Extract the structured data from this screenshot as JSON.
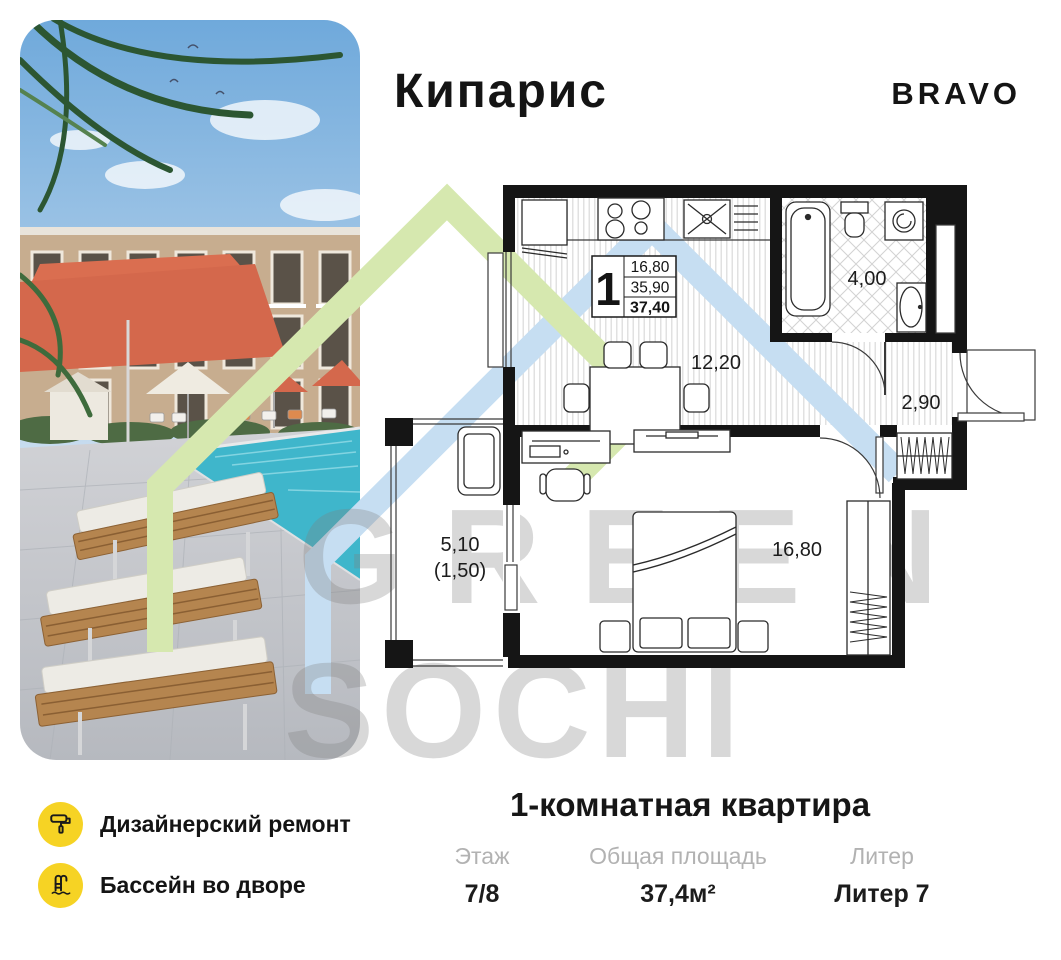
{
  "header": {
    "title": "Кипарис",
    "brand": "BRAVO"
  },
  "floorplan": {
    "stat_box": {
      "rooms": "1",
      "row1": "16,80",
      "row2": "35,90",
      "row3": "37,40"
    },
    "labels": {
      "kitchen": "12,20",
      "bathroom": "4,00",
      "hallway": "2,90",
      "bedroom": "16,80",
      "balcony": "5,10",
      "balcony_reduced": "(1,50)"
    }
  },
  "watermark": {
    "word1": "GREEN",
    "word2": "SOCHI"
  },
  "features": [
    {
      "icon": "paint-roller-icon",
      "label": "Дизайнерский ремонт"
    },
    {
      "icon": "pool-ladder-icon",
      "label": "Бассейн во дворе"
    }
  ],
  "summary": {
    "title": "1-комнатная квартира",
    "columns": [
      {
        "label": "Этаж",
        "value": "7/8"
      },
      {
        "label": "Общая площадь",
        "value": "37,4м²"
      },
      {
        "label": "Литер",
        "value": "Литер 7"
      }
    ]
  },
  "colors": {
    "accent_yellow": "#F6D324",
    "watermark_green": "#d6e8af",
    "watermark_blue": "#c6def2",
    "watermark_gray": "#d9d9d9",
    "umbrella_red": "#d4684c",
    "pool_water": "#3fb6cb",
    "wall_black": "#151515"
  }
}
